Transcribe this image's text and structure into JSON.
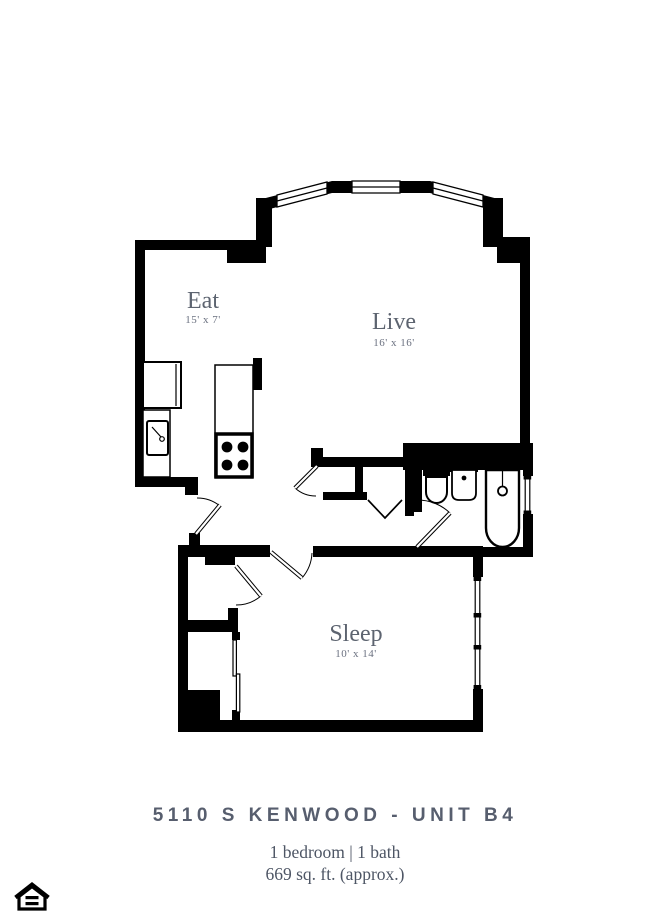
{
  "rooms": {
    "eat": {
      "name": "Eat",
      "dims": "15' x 7'"
    },
    "live": {
      "name": "Live",
      "dims": "16' x 16'"
    },
    "sleep": {
      "name": "Sleep",
      "dims": "10' x 14'"
    }
  },
  "footer": {
    "title": "5110 S KENWOOD - UNIT B4",
    "line1": "1 bedroom | 1 bath",
    "line2": "669 sq. ft. (approx.)"
  },
  "colors": {
    "walls": "#000000",
    "room_label": "#5d6470",
    "room_dims": "#6b7180",
    "title": "#575e6e",
    "subtitle": "#4e5665",
    "background": "#ffffff"
  },
  "icons": {
    "equal_housing": "equal-housing-opportunity-logo"
  }
}
